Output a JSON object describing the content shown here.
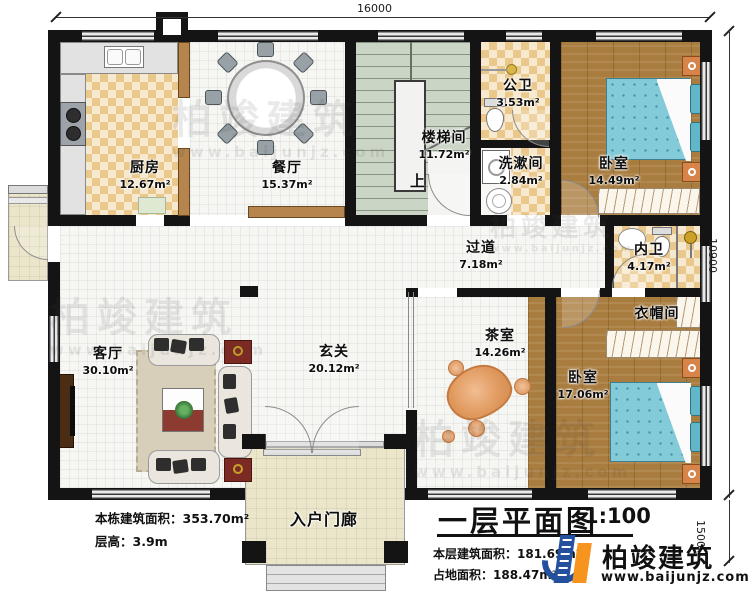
{
  "plan": {
    "dimensions": {
      "width_mm": "16000",
      "depth_mm": "10900",
      "porch_depth_mm": "1500"
    },
    "stair_up_label": "上",
    "rooms": {
      "kitchen": {
        "label": "厨房",
        "area": "12.67m²"
      },
      "dining": {
        "label": "餐厅",
        "area": "15.37m²"
      },
      "stairwell": {
        "label": "楼梯间",
        "area": "11.72m²"
      },
      "public_bath": {
        "label": "公卫",
        "area": "3.53m²"
      },
      "washroom": {
        "label": "洗漱间",
        "area": "2.84m²"
      },
      "bedroom_top": {
        "label": "卧室",
        "area": "14.49m²"
      },
      "corridor": {
        "label": "过道",
        "area": "7.18m²"
      },
      "ensuite_bath": {
        "label": "内卫",
        "area": "4.17m²"
      },
      "cloakroom": {
        "label": "衣帽间"
      },
      "bedroom_bottom": {
        "label": "卧室",
        "area": "17.06m²"
      },
      "tea_room": {
        "label": "茶室",
        "area": "14.26m²"
      },
      "foyer": {
        "label": "玄关",
        "area": "20.12m²"
      },
      "living_room": {
        "label": "客厅",
        "area": "30.10m²"
      },
      "porch": {
        "label": "入户门廊"
      }
    }
  },
  "notes_left": {
    "line1": "本栋建筑面积：353.70m²",
    "line2": "层高：3.9m"
  },
  "title_block": {
    "title": "一层平面图",
    "scale": "1:100",
    "line1": "本层建筑面积：181.69m²",
    "line2": "占地面积：188.47m²"
  },
  "brand": {
    "name": "柏竣建筑",
    "website": "www.baijunjz.com"
  },
  "watermark": {
    "name": "柏竣建筑",
    "website": "www.baijunjz.com"
  },
  "colors": {
    "wall": "#141414",
    "checker_tile": "#eac88b",
    "wood_floor": "#a97c3f",
    "stair_floor": "#cbd5c6",
    "porch_floor": "#ebe5ca",
    "bed": "#84cbd9",
    "brand_blue": "#23519e",
    "brand_orange": "#f7941e"
  }
}
